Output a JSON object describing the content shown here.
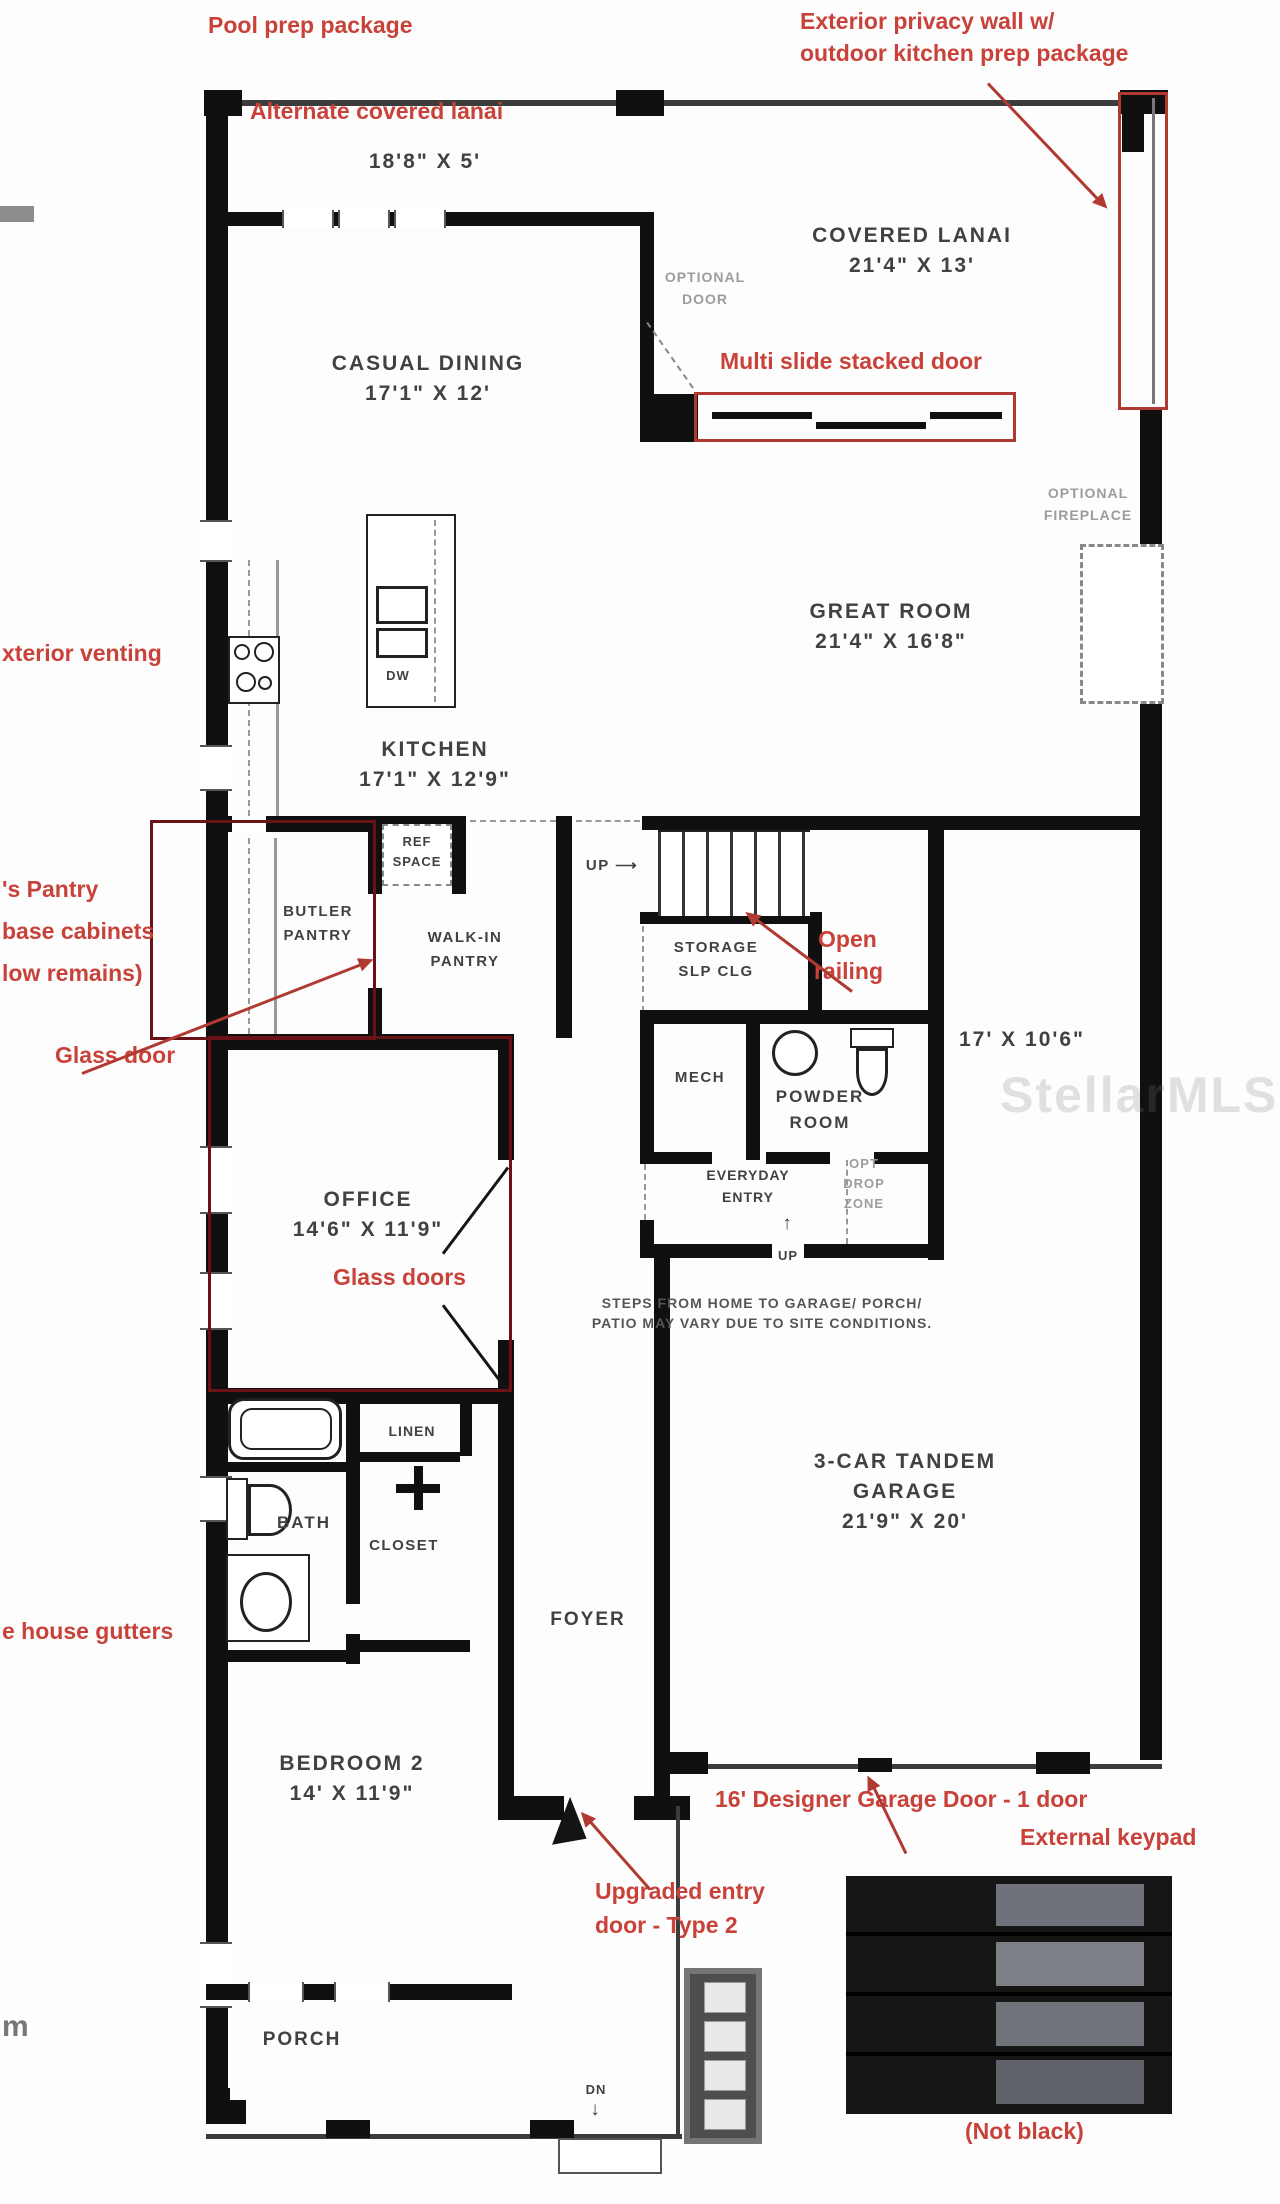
{
  "annotations": {
    "pool_prep": "Pool prep package",
    "privacy_wall_1": "Exterior privacy wall w/",
    "privacy_wall_2": "outdoor kitchen prep package",
    "alt_lanai": "Alternate covered lanai",
    "multi_slide": "Multi slide stacked door",
    "exterior_venting": "xterior venting",
    "pantry_cut_1": "'s Pantry",
    "pantry_cut_2": "base cabinets",
    "pantry_cut_3": "low remains)",
    "glass_door": "Glass door",
    "open_railing_1": "Open",
    "open_railing_2": "railing",
    "glass_doors": "Glass doors",
    "house_gutters": "e house gutters",
    "garage_door": "16' Designer Garage Door - 1 door",
    "external_keypad": "External keypad",
    "upgraded_entry_1": "Upgraded entry",
    "upgraded_entry_2": "door - Type 2",
    "not_black": "(Not black)",
    "corner_m": "m"
  },
  "rooms": {
    "covered_lanai": {
      "name": "COVERED LANAI",
      "dims": "21'4\" X 13'"
    },
    "alt_lanai": {
      "dims": "18'8\" X 5'"
    },
    "casual_dining": {
      "name": "CASUAL DINING",
      "dims": "17'1\" X 12'"
    },
    "great_room": {
      "name": "GREAT ROOM",
      "dims": "21'4\" X 16'8\""
    },
    "kitchen": {
      "name": "KITCHEN",
      "dims": "17'1\" X 12'9\""
    },
    "butler_pantry": {
      "line1": "BUTLER",
      "line2": "PANTRY"
    },
    "walk_in_pantry": {
      "line1": "WALK-IN",
      "line2": "PANTRY"
    },
    "ref_space": {
      "line1": "REF",
      "line2": "SPACE"
    },
    "storage": {
      "line1": "STORAGE",
      "line2": "SLP CLG"
    },
    "mech": {
      "name": "MECH"
    },
    "powder": {
      "line1": "POWDER",
      "line2": "ROOM"
    },
    "garage_bay": {
      "dims": "17' X 10'6\""
    },
    "everyday_entry": {
      "line1": "EVERYDAY",
      "line2": "ENTRY"
    },
    "opt_drop_zone": {
      "line1": "OPT",
      "line2": "DROP",
      "line3": "ZONE"
    },
    "office": {
      "name": "OFFICE",
      "dims": "14'6\" X 11'9\""
    },
    "garage": {
      "line1": "3-CAR TANDEM",
      "line2": "GARAGE",
      "dims": "21'9\" X 20'"
    },
    "bath": {
      "name": "BATH"
    },
    "linen": {
      "name": "LINEN"
    },
    "closet": {
      "name": "CLOSET"
    },
    "foyer": {
      "name": "FOYER"
    },
    "bedroom2": {
      "name": "BEDROOM 2",
      "dims": "14' X 11'9\""
    },
    "porch": {
      "name": "PORCH"
    },
    "dw": {
      "name": "DW"
    }
  },
  "labels": {
    "optional_door_1": "OPTIONAL",
    "optional_door_2": "DOOR",
    "optional_fireplace_1": "OPTIONAL",
    "optional_fireplace_2": "FIREPLACE",
    "up_stairs": "UP ⟶",
    "up": "UP",
    "up_arrow": "↑",
    "dn": "DN",
    "dn_arrow": "↓"
  },
  "notes": {
    "steps_line1": "STEPS FROM HOME TO GARAGE/ PORCH/",
    "steps_line2": "PATIO MAY VARY DUE TO SITE CONDITIONS."
  },
  "watermark": "StellarMLS",
  "colors": {
    "annotation_red": "#c8423a",
    "highlight_red": "#b03a32",
    "outline_maroon": "#6b1217",
    "wall_black": "#101010"
  }
}
